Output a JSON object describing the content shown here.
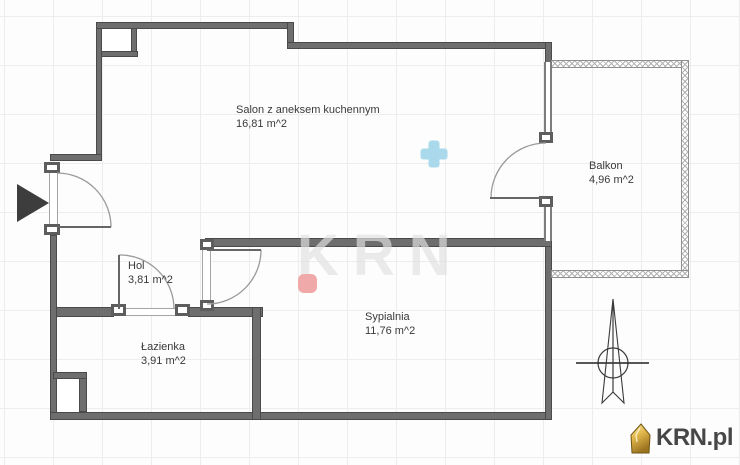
{
  "rooms": {
    "salon": {
      "name": "Salon z aneksem kuchennym",
      "area": "16,81 m^2"
    },
    "balkon": {
      "name": "Balkon",
      "area": "4,96 m^2"
    },
    "hol": {
      "name": "Hol",
      "area": "3,81 m^2"
    },
    "lazienka": {
      "name": "Łazienka",
      "area": "3,91 m^2"
    },
    "sypialnia": {
      "name": "Sypialnia",
      "area": "11,76 m^2"
    }
  },
  "branding": {
    "logo_text": "KRN.pl",
    "watermark_text": "KRN"
  },
  "markers": {
    "plus_color": "#a9d9eb",
    "square_color": "#efa9a9"
  },
  "colors": {
    "wall": "#6e6e6e",
    "wall_edge": "#4a4a4a",
    "grid": "#ededed",
    "logo_house": "#c89030"
  }
}
